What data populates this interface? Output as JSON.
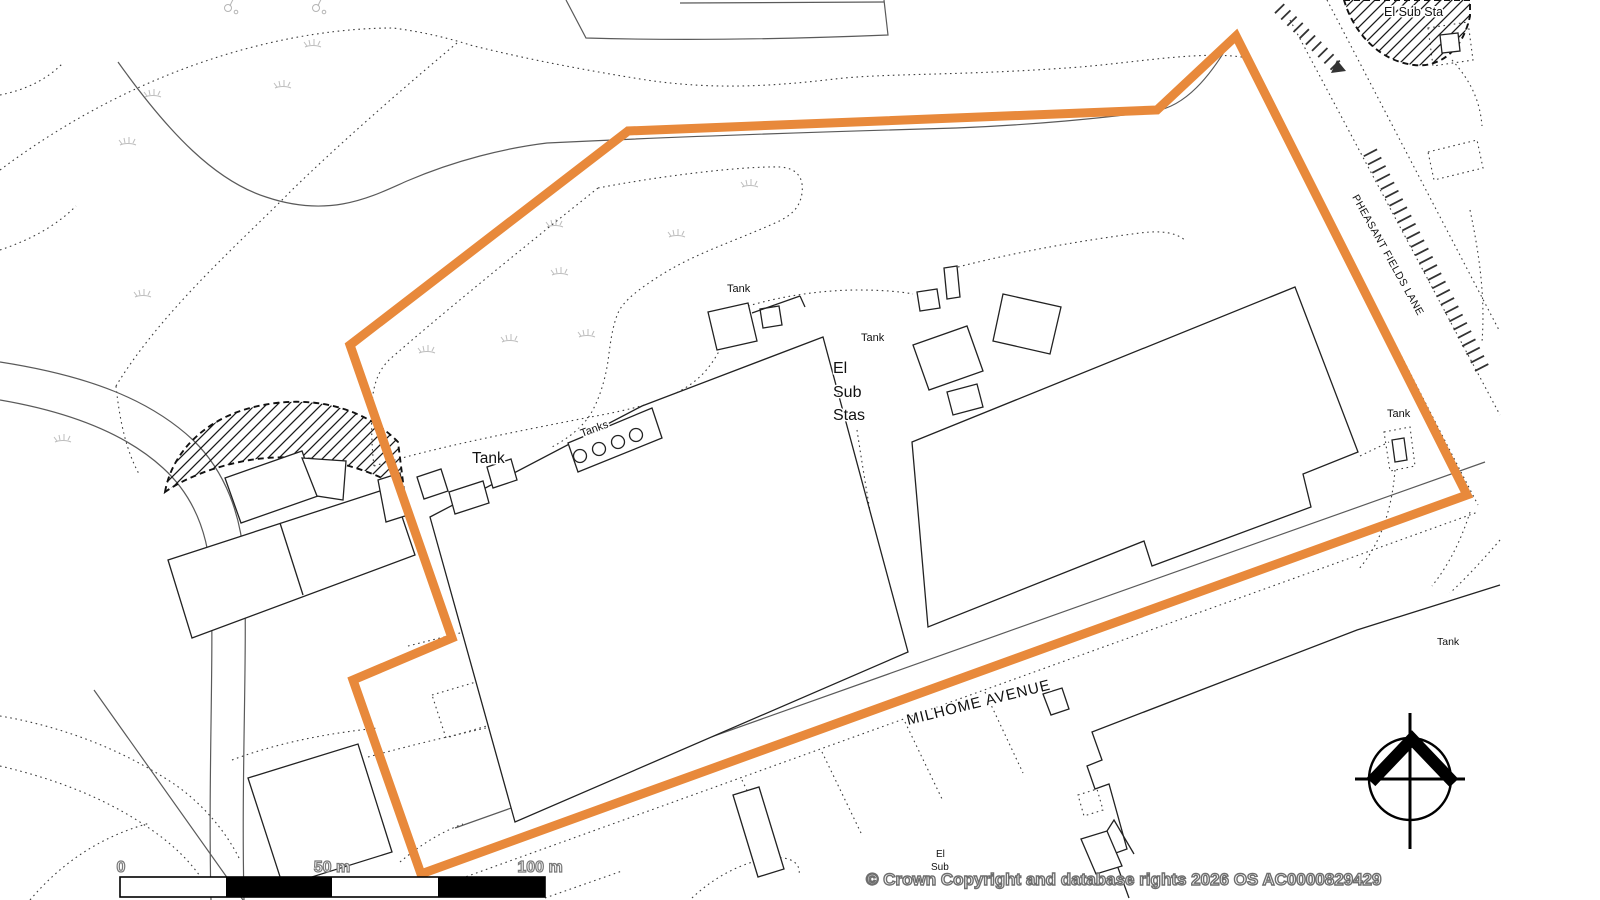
{
  "map": {
    "labels": {
      "el_sub_sta_top": "El Sub Sta",
      "tank_top_center": "Tank",
      "tank_center": "Tank",
      "el_sub_stas": [
        "El",
        "Sub",
        "Stas"
      ],
      "tanks_platform": "Tanks",
      "tank_large_west": "Tank",
      "tank_lane": "Tank",
      "tank_southeast": "Tank",
      "pheasant_fields_lane": "PHEASANT FIELDS LANE",
      "milhome_avenue": "MILHOME AVENUE",
      "el_sub_bottom_line1": "El",
      "el_sub_bottom_line2": "Sub"
    },
    "scale_bar": {
      "start": "0",
      "mid": "50 m",
      "end": "100 m"
    },
    "attribution": "© Crown Copyright and database rights 2026 OS AC0000829429",
    "colors": {
      "site_boundary": "#E8893B",
      "building_outline": "#222222",
      "road_line": "#5a5a5a",
      "dotted_line": "#3c3c3c",
      "hatch": "#1a1a1a",
      "vegetation": "#bdbdbd"
    },
    "icons": {
      "north_arrow": "north-arrow-compass"
    }
  }
}
